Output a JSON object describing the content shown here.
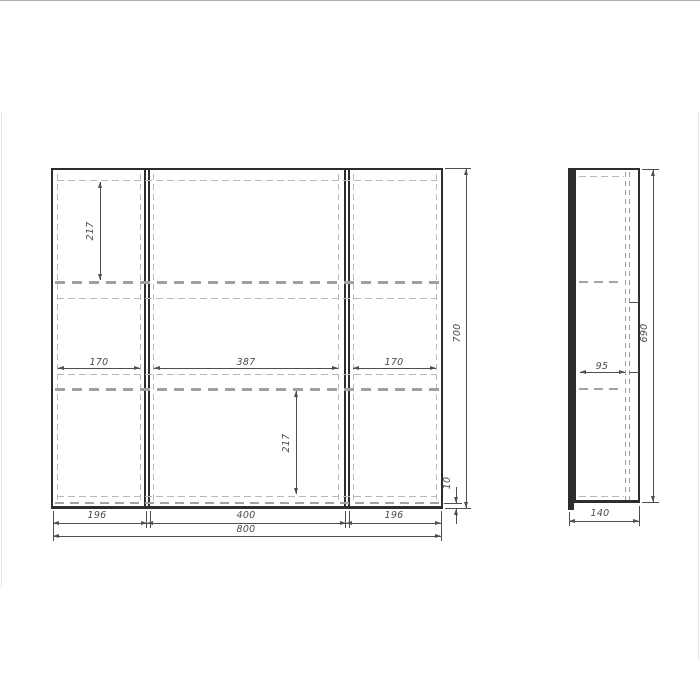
{
  "title": "Mirror cabinet technical drawing",
  "colors": {
    "background": "#ffffff",
    "solid_line": "#2d2d2d",
    "dimension_line": "#4f4f4f",
    "hidden_dash": "#a0a0a0",
    "frame_border": "#adadad"
  },
  "front_view": {
    "dims": {
      "top_shelf_offset": "217",
      "left_shelf_width": "170",
      "middle_shelf_width": "387",
      "right_shelf_width": "170",
      "overall_height": "700",
      "bottom_overhang": "10",
      "bottom_shelf_offset": "217",
      "left_door_width": "196",
      "middle_door_width": "400",
      "right_door_width": "196",
      "overall_width": "800"
    }
  },
  "side_view": {
    "dims": {
      "shelf_depth": "95",
      "carcass_height": "690",
      "overall_depth": "140"
    }
  }
}
